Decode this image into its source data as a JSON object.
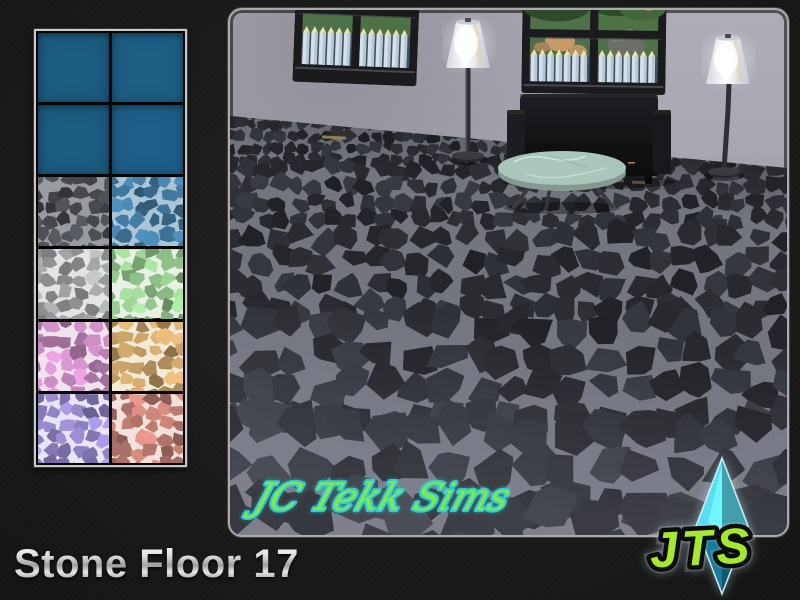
{
  "page": {
    "title": "Stone Floor 17"
  },
  "branding": {
    "signature": "JC Tekk Sims",
    "logo_text": "JTS",
    "logo_colors": {
      "diamond_light": "#56d2e6",
      "diamond_dark": "#17718a",
      "text": "#a6e72f"
    },
    "signature_colors": {
      "fill": "#7fe94d",
      "outline": "#35d1d6"
    }
  },
  "swatch_panel": {
    "rows": 6,
    "cols": 2,
    "swatches": [
      {
        "name": "plain-blue-1",
        "type": "solid",
        "color": "#1d5c82"
      },
      {
        "name": "plain-blue-2",
        "type": "solid",
        "color": "#1e5f86"
      },
      {
        "name": "plain-blue-3",
        "type": "solid",
        "color": "#1d5c82"
      },
      {
        "name": "plain-blue-4",
        "type": "solid",
        "color": "#1f6089"
      },
      {
        "name": "dark-gray-stone",
        "type": "stone",
        "grout": "#989ca1",
        "stone": "#45474c"
      },
      {
        "name": "blue-stone",
        "type": "stone",
        "grout": "#a9c6d8",
        "stone": "#40759a"
      },
      {
        "name": "light-gray-stone",
        "type": "stone",
        "grout": "#e4e4e6",
        "stone": "#9fa0a2"
      },
      {
        "name": "green-stone",
        "type": "stone",
        "grout": "#e9f1e3",
        "stone": "#8cbc86"
      },
      {
        "name": "pink-stone",
        "type": "stone",
        "grout": "#f0e3ee",
        "stone": "#bb82b4"
      },
      {
        "name": "tan-stone",
        "type": "stone",
        "grout": "#f3ebd8",
        "stone": "#bf9a64"
      },
      {
        "name": "purple-stone",
        "type": "stone",
        "grout": "#e9e5f3",
        "stone": "#9082c3"
      },
      {
        "name": "red-stone",
        "type": "stone",
        "grout": "#f3e1dc",
        "stone": "#bd7c72"
      }
    ]
  },
  "scene": {
    "wall_color": "#aeacb7",
    "floor": {
      "grout": "#73757f",
      "stone": "#2c2e34",
      "accent": "#bf9f5f"
    },
    "window_view": {
      "grass": "#4f7147",
      "foliage_dark": "#2e4a2c",
      "foliage_light": "#44663c",
      "rock_tan": "#c59a66",
      "rock_gray": "#6a6e65",
      "fruit": "#cf8d4e",
      "fence": "#d7dfe8",
      "fence_shade": "#9fb2c6",
      "fence_tip": "#e9e3ae",
      "fence_back": "#3c5262"
    },
    "furniture": {
      "sofa": "#17171a",
      "ottoman": "#a9c6ba",
      "lamp_shade": "#eef0f4",
      "lamp_pole": "#2e2e33"
    }
  }
}
